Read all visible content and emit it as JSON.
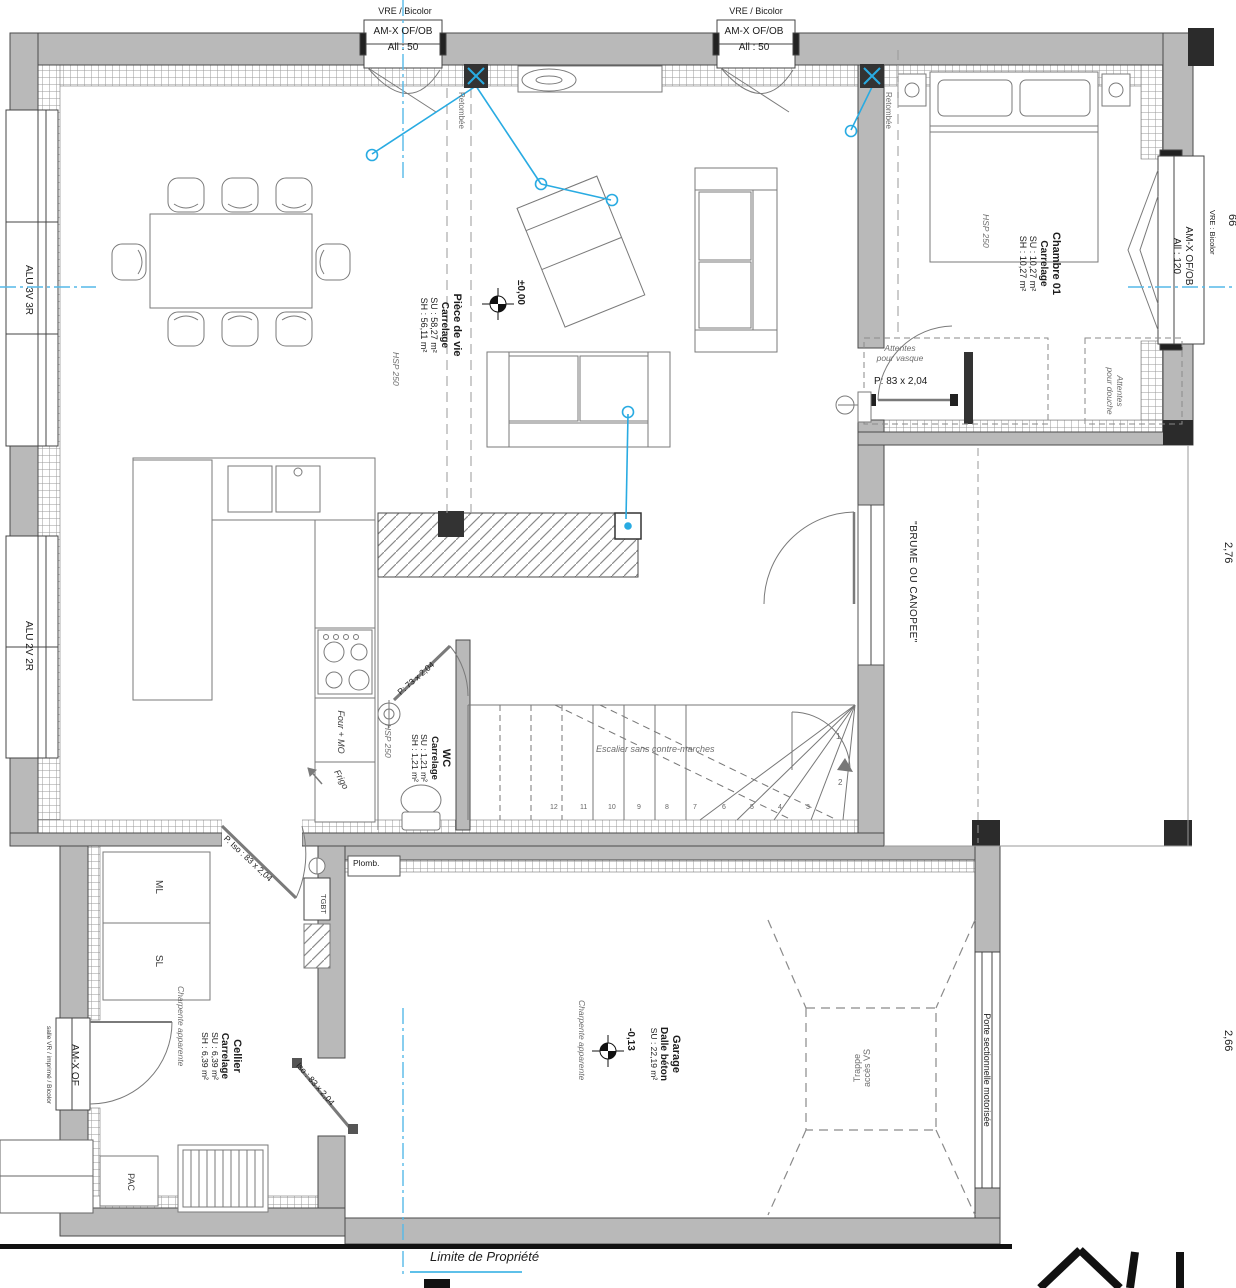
{
  "windows": {
    "top_left": {
      "header": "VRE / Bicolor",
      "name": "AM-X OF/OB",
      "allege": "All : 50"
    },
    "top_right": {
      "header": "VRE / Bicolor",
      "name": "AM-X OF/OB",
      "allege": "All : 50"
    },
    "right": {
      "name": "AM-X OF/OB",
      "allege": "All : 120",
      "side": "VRE : Bicolor"
    },
    "left_upper": "ALU 3V 3R",
    "left_lower": "ALU 2V 2R",
    "cellier_door": "AM-X OF",
    "cellier_note": "salle VR / imprimé / Bicolor"
  },
  "rooms": {
    "piece_de_vie": {
      "name": "Pièce de vie",
      "floor": "Carrelage",
      "su": "SU : 58,27 m²",
      "sh": "SH : 56,11 m²"
    },
    "chambre": {
      "name": "Chambre 01",
      "floor": "Carrelage",
      "su": "SU : 10,27 m²",
      "sh": "SH : 10,27 m²"
    },
    "wc": {
      "name": "WC",
      "floor": "Carrelage",
      "su": "SU : 1,21 m²",
      "sh": "SH : 1,21 m²"
    },
    "cellier": {
      "name": "Cellier",
      "floor": "Carrelage",
      "su": "SU : 6,39 m²",
      "sh": "SH : 6,39 m²"
    },
    "garage": {
      "name": "Garage",
      "floor": "Dalle béton",
      "su": "SU : 22,19 m²"
    }
  },
  "doors": {
    "vasque": "P: 83 x 2,04",
    "wc": "P: 73 x 2,04",
    "cellier": "P. Iso : 83 x 2,04",
    "garage": "Iso : 83 x 2,04",
    "sectionnelle": "Porte sectionnelle motorisée",
    "bay": "\"BRUME OU CANOPEE\""
  },
  "annotations": {
    "retombee": "Retombée",
    "attentes_vasque_1": "Attentes",
    "attentes_vasque_2": "pour vasque",
    "attentes_douche_1": "Attentes",
    "attentes_douche_2": "pour douche",
    "escalier": "Escalier sans contre-marches",
    "trappe_1": "Trappe",
    "trappe_2": "accès VS",
    "limite": "Limite de Propriété",
    "level_main": "±0,00",
    "level_garage": "-0,13",
    "charpente": "Charpente apparente",
    "hsp": "HSP 250"
  },
  "equipment": {
    "ml": "ML",
    "sl": "SL",
    "pac": "PAC",
    "tgbt": "TGBT",
    "four": "Four + MO",
    "frigo": "Frigo",
    "plomb": "Plomb."
  },
  "stairs": {
    "numbers": [
      "12",
      "11",
      "10",
      "9",
      "8",
      "7",
      "6",
      "5",
      "4",
      "3",
      "2",
      "1"
    ]
  },
  "dims": {
    "right_upper": "2,76",
    "right_lower": "2,66",
    "right_top": "66"
  },
  "colors": {
    "cable": "#29abe2",
    "wall_fill": "#b9b9b9",
    "wall_line": "#4a4a4a"
  }
}
